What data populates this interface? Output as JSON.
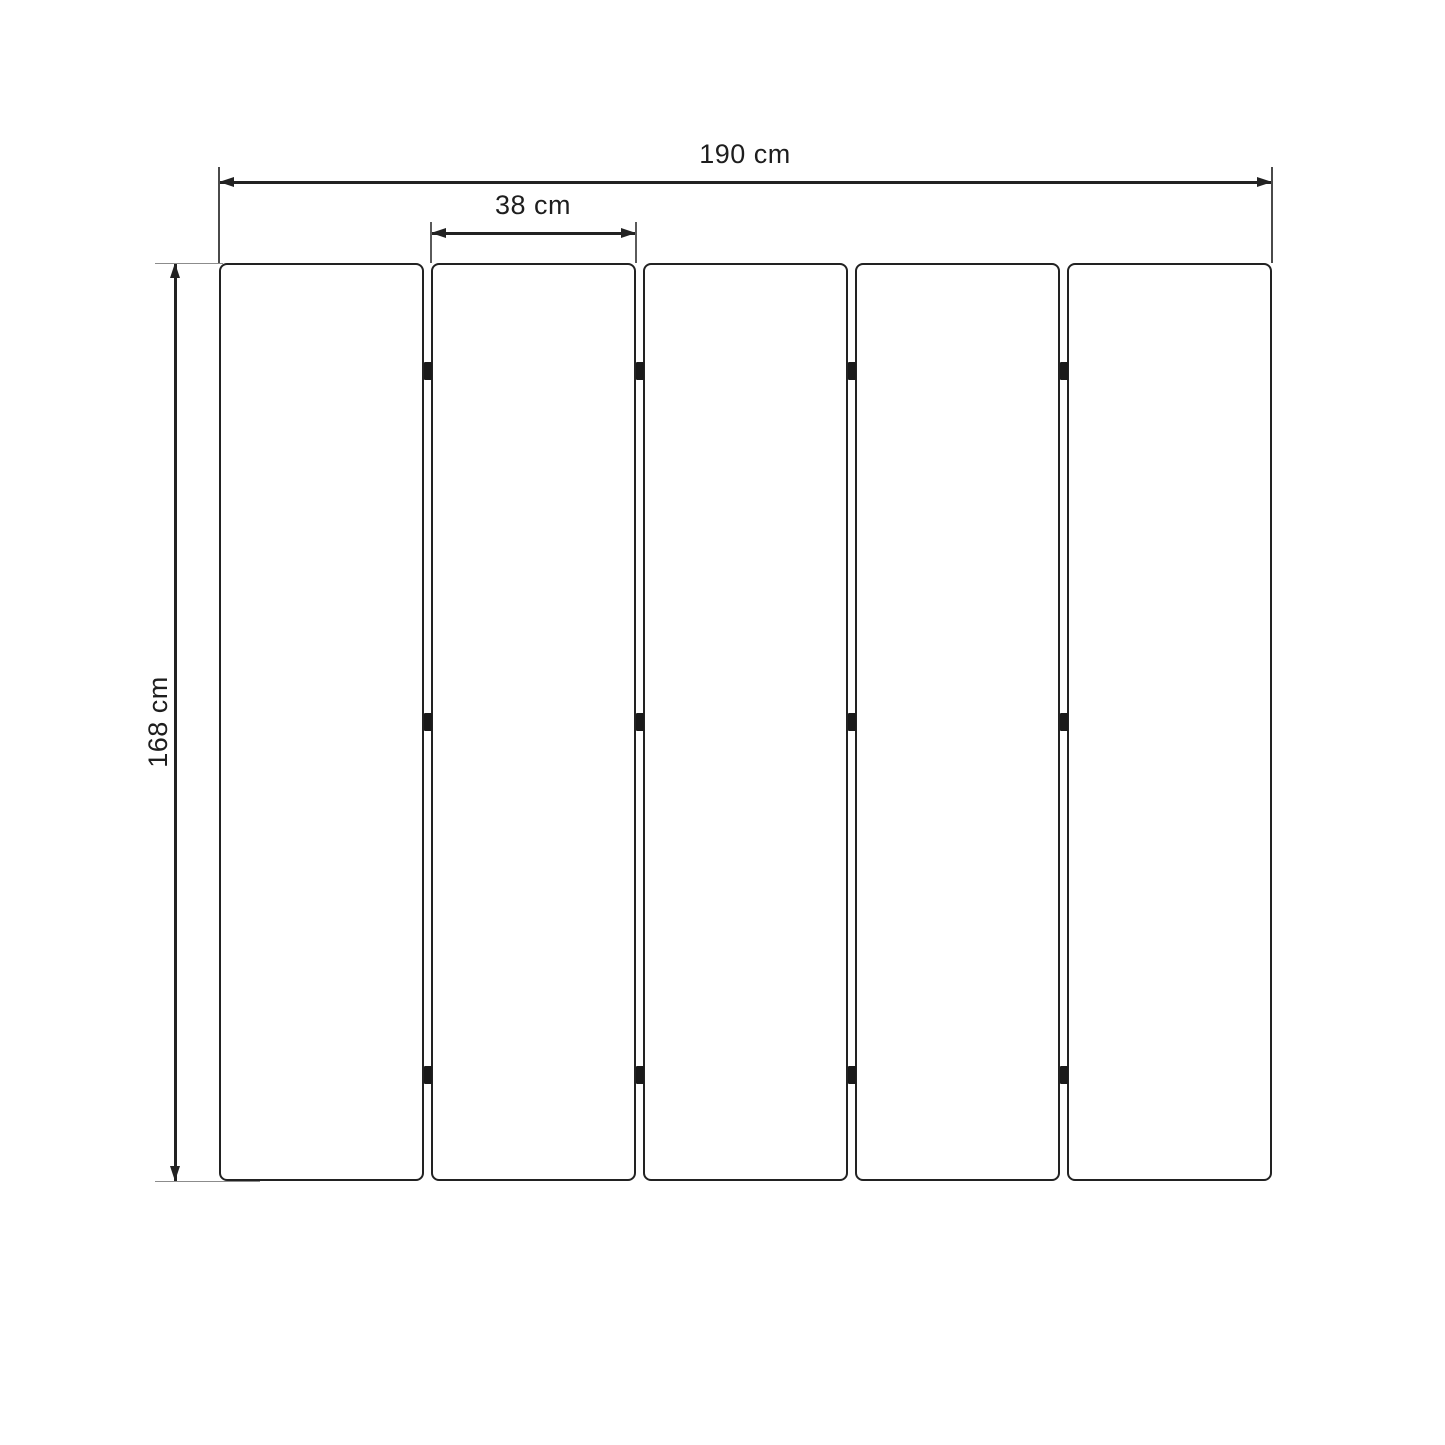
{
  "dimensions": {
    "total_width_label": "190 cm",
    "panel_width_label": "38 cm",
    "height_label": "168 cm"
  },
  "structure": {
    "panel_count": 5,
    "joint_count": 4,
    "hinges_per_joint": 3,
    "hinge_offsets_pct": [
      11.8,
      50,
      88.4
    ]
  },
  "colors": {
    "line": "#222222",
    "extension_line": "#8c8c8c",
    "hinge": "#1a1a1a",
    "text": "#1e1e1e",
    "background": "#ffffff"
  }
}
